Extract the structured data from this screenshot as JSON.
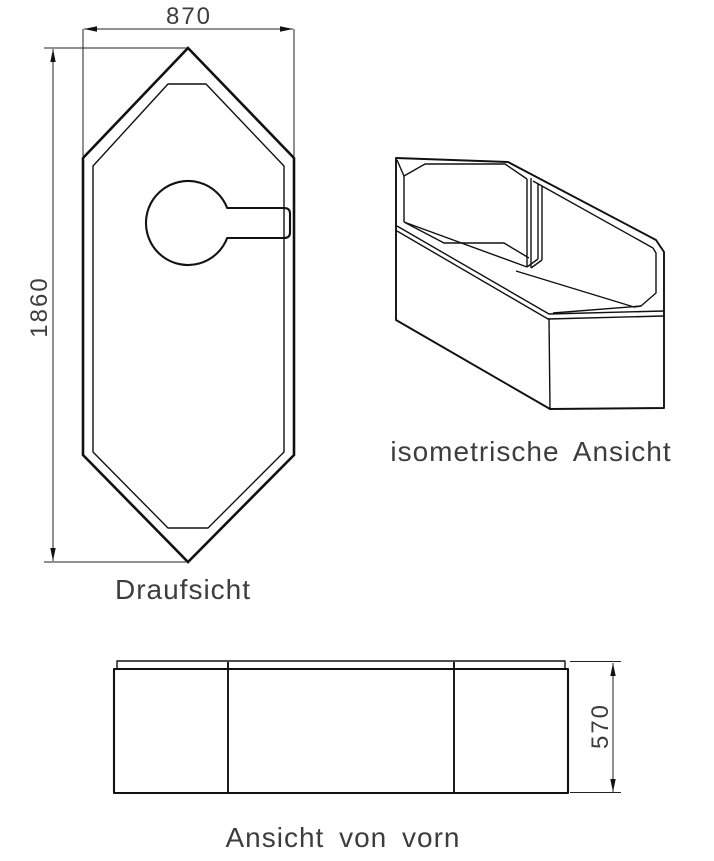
{
  "drawing": {
    "type": "technical-drawing",
    "subject": "corner bathtub / bathtub carrier, three orthographic-and-isometric views",
    "views": {
      "top": {
        "label": "Draufsicht"
      },
      "iso": {
        "label": "isometrische Ansicht"
      },
      "front": {
        "label": "Ansicht von vorn"
      }
    },
    "dimensions": {
      "width": {
        "value": "870",
        "unit": "mm",
        "location": "top view, horizontal, top"
      },
      "length": {
        "value": "1860",
        "unit": "mm",
        "location": "top view, vertical, left"
      },
      "height": {
        "value": "570",
        "unit": "mm",
        "location": "front view, vertical, right"
      }
    },
    "colors": {
      "line": "#111111",
      "text": "#3d3d3d",
      "background": "#ffffff"
    }
  }
}
